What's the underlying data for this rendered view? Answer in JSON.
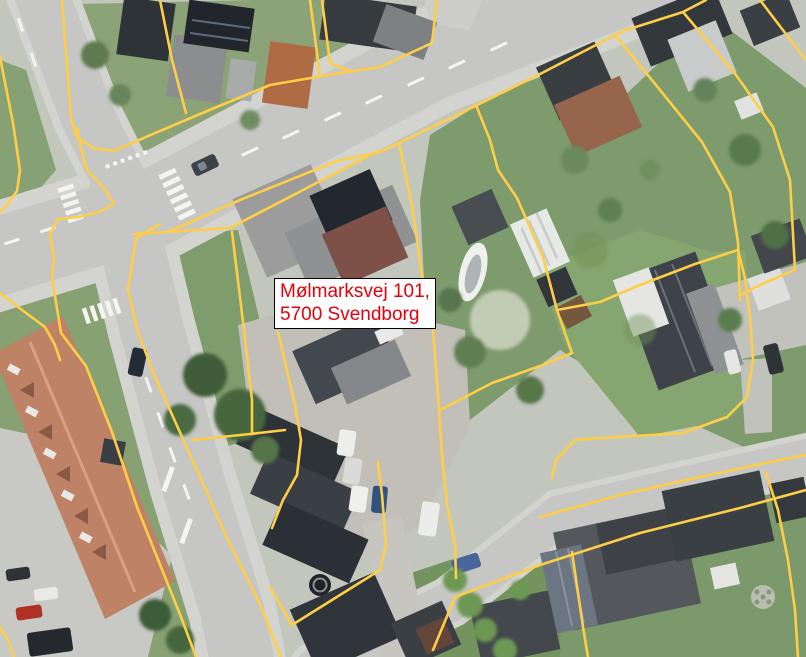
{
  "map": {
    "type": "aerial-photo-with-cadastral-overlay",
    "label": {
      "line1": "Mølmarksvej 101,",
      "line2": "5700 Svendborg"
    },
    "colors": {
      "parcel_line": "#FFCE47",
      "label_text": "#E60009",
      "label_bg": "#FFFFFF",
      "label_border": "#000000",
      "road": "#C6C6C4",
      "sidewalk": "#D3D3D0",
      "grass": "#7E9B6D",
      "lawn_bright": "#85A671",
      "roof_dark": "#33383D",
      "roof_terracotta": "#BE8266",
      "roof_orange": "#AE6B44",
      "marking_white": "#F4F4F1"
    }
  }
}
